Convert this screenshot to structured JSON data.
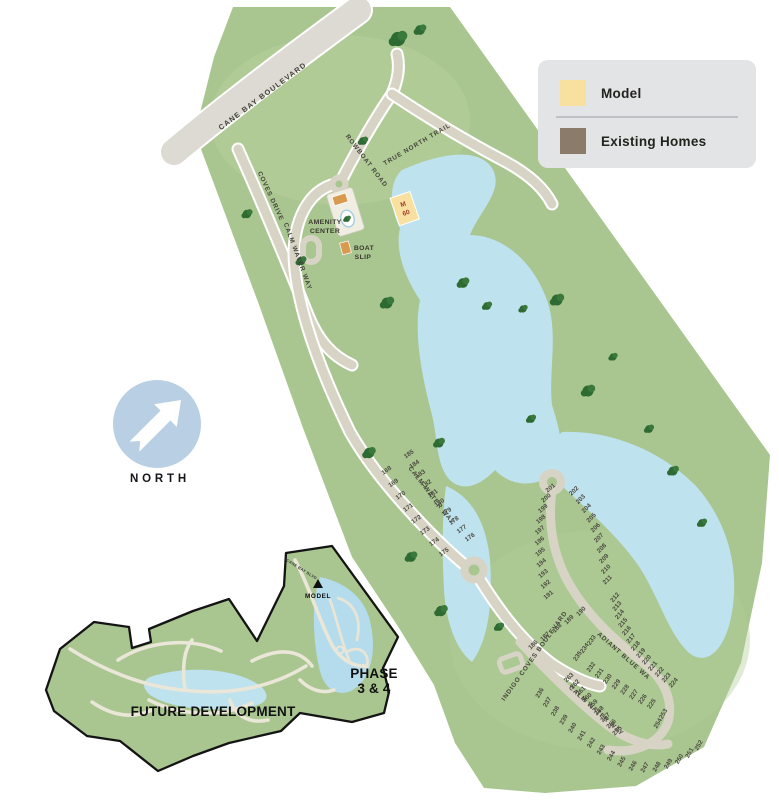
{
  "colors": {
    "land": "#A9C690",
    "water": "#BFE2EF",
    "road": "#D8D4C5",
    "boulevard": "#DCDAD2",
    "existing_home": "#8A7B6A",
    "model": "#F8E1A0",
    "available_lot": "#F4F3EB",
    "legend_bg": "#E3E4E6",
    "north_blue": "#B9CFE3",
    "model_text": "#A23D2B",
    "tree": "#2E6B33",
    "inset_outline": "#141414"
  },
  "legend": {
    "items": [
      {
        "label": "Model",
        "color": "#F8E1A0"
      },
      {
        "label": "Existing Homes",
        "color": "#8A7B6A"
      }
    ]
  },
  "north_label": "NORTH",
  "streets": {
    "cane_bay": "CANE BAY BOULEVARD",
    "coves": "COVES DRIVE",
    "rowboat": "ROWBOAT ROAD",
    "true_north": "TRUE NORTH TRAIL",
    "calm_water": "CALM WATER WAY",
    "indigo": "INDIGO COVES BOULEVARD",
    "radiant": "RADIANT BLUE WAY"
  },
  "pois": {
    "amenity_center": [
      "AMENITY",
      "CENTER"
    ],
    "boat_slip": [
      "BOAT",
      "SLIP"
    ]
  },
  "model_lot": {
    "letter": "M",
    "number": "60"
  },
  "inset": {
    "future": "FUTURE DEVELOPMENT",
    "phase": [
      "PHASE",
      "3 & 4"
    ],
    "model": "MODEL",
    "street_top": "CANE BAY BLVD"
  },
  "lots": {
    "calm_left": [
      168,
      169,
      170,
      171,
      172,
      173,
      174,
      175
    ],
    "calm_right": [
      185,
      184,
      183,
      182,
      181,
      180,
      179,
      178,
      177,
      176
    ],
    "indigo_row": [
      186,
      187,
      188,
      189,
      190
    ],
    "loop_left": [
      191,
      192,
      193,
      194,
      195,
      196,
      197,
      198,
      199,
      200,
      201
    ],
    "loop_right": [
      202,
      203,
      204,
      205,
      206,
      207,
      208,
      209,
      210,
      211
    ],
    "radiant_outer": [
      212,
      213,
      214,
      215,
      216,
      217,
      218,
      219,
      220,
      221,
      222,
      223,
      224
    ],
    "radiant_inner": [
      232,
      231,
      230,
      229,
      228,
      227,
      226,
      225
    ],
    "spur": [
      233,
      234,
      235
    ],
    "calm_lower_sw": [
      236,
      237,
      238,
      239,
      240,
      241,
      242,
      243,
      244,
      245,
      246,
      247,
      248,
      249,
      250,
      251,
      252
    ],
    "calm_lower_ne": [
      263,
      262,
      261,
      260,
      259,
      258,
      257,
      256,
      255
    ],
    "pair": [
      253,
      254
    ]
  }
}
